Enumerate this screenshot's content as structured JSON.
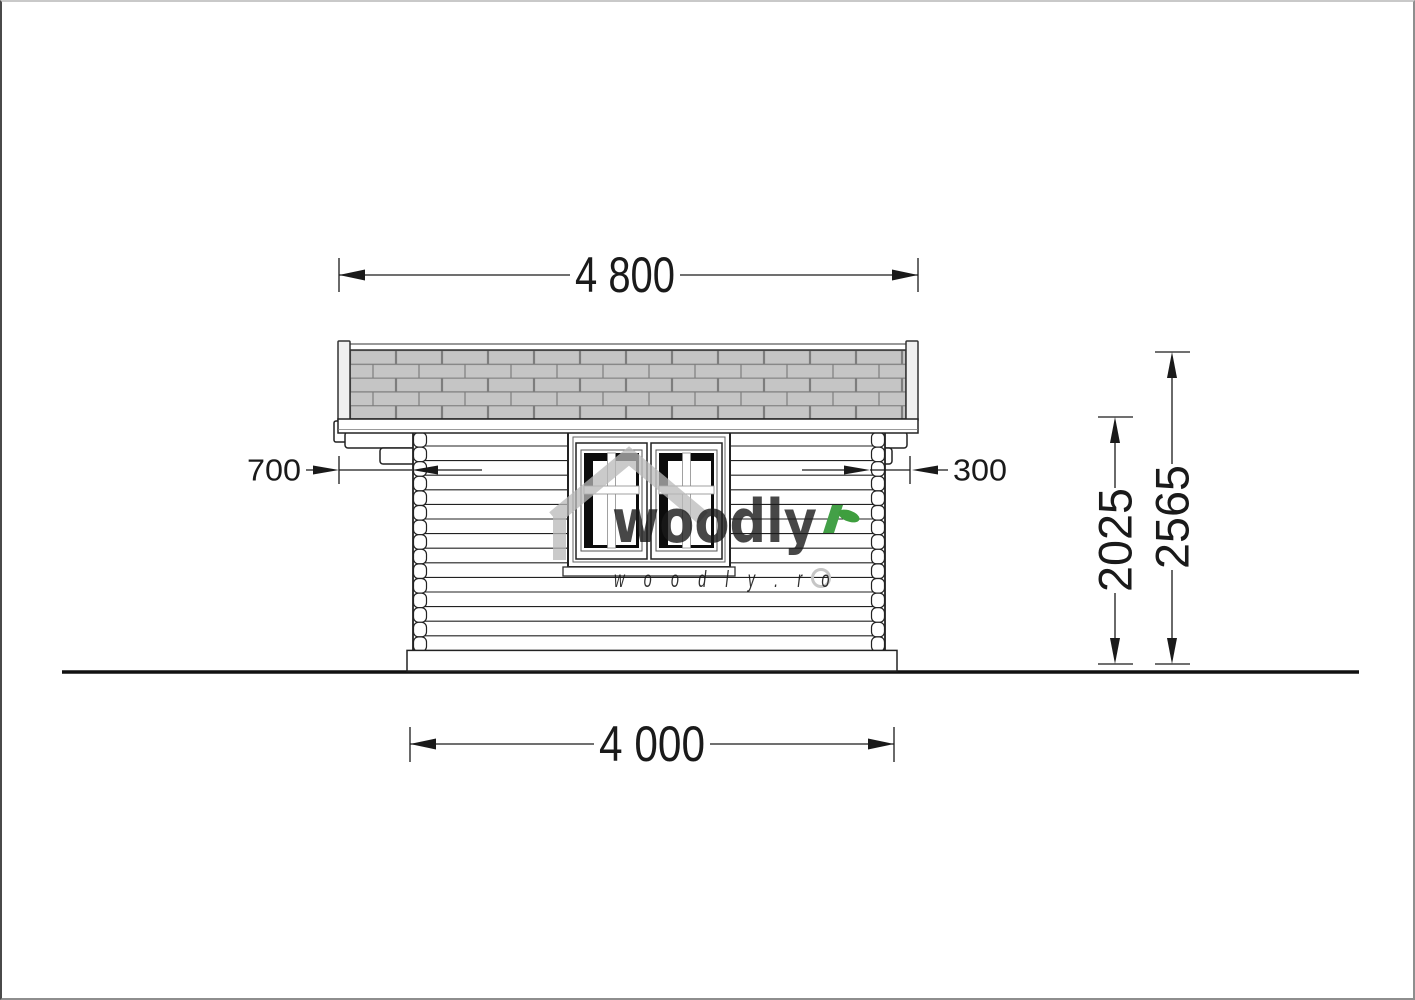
{
  "title": "Log cabin side elevation drawing",
  "dimensions": {
    "roof_length": "4 800",
    "base_length": "4 000",
    "left_overhang": "700",
    "right_overhang": "300",
    "eave_height": "2025",
    "ridge_height": "2565"
  },
  "watermark": {
    "logo_text": "woodly",
    "site_text": "w o o d l y . r o"
  },
  "colors": {
    "line": "#222222",
    "shingle_fill": "#c5c5c5",
    "shingle_line": "#7d7d7d",
    "watermark_gray": "#b9b9b9",
    "brand_green": "#43a047"
  }
}
